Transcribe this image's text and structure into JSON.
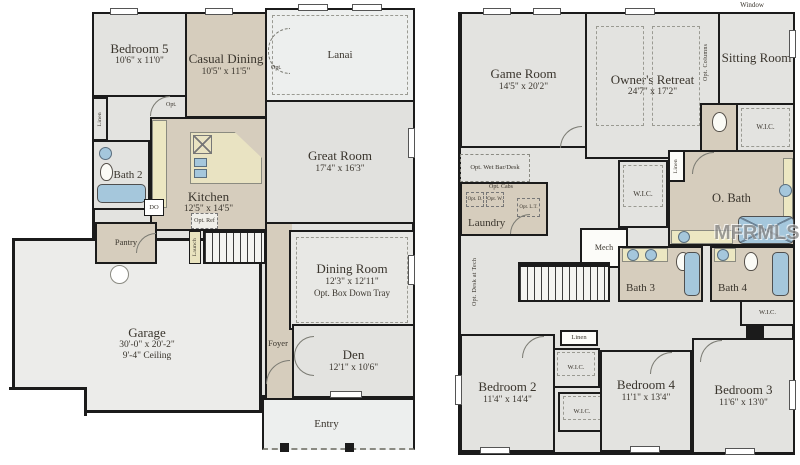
{
  "watermark": {
    "text": "MFRMLS"
  },
  "colors": {
    "wall": "#1b1b1b",
    "room_gray": "#e3e3e0",
    "tan": "#d6cdbd",
    "porch_gray": "#edefee",
    "counter_yellow": "#ece7c2",
    "fixture_blue": "#a5c7dc",
    "label_text": "#3a352d"
  },
  "floor1": {
    "rooms": {
      "bedroom5": {
        "name": "Bedroom 5",
        "dims": "10'6\" x 11'0\""
      },
      "casual_dining": {
        "name": "Casual Dining",
        "dims": "10'5\" x 11'5\""
      },
      "lanai": {
        "name": "Lanai"
      },
      "great_room": {
        "name": "Great Room",
        "dims": "17'4\" x 16'3\""
      },
      "linen": {
        "name": "Linen"
      },
      "bath2": {
        "name": "Bath 2"
      },
      "kitchen": {
        "name": "Kitchen",
        "dims": "12'5\" x 14'5\"",
        "double_oven": "DO",
        "opt_ref": "Opt. Ref",
        "launch": "Launch"
      },
      "pantry": {
        "name": "Pantry"
      },
      "dining_room": {
        "name": "Dining Room",
        "dims": "12'3\" x 12'11\"",
        "note": "Opt. Box Down Tray"
      },
      "garage": {
        "name": "Garage",
        "dims": "30'-0\" x 20'-2\"",
        "ceiling": "9'-4\" Ceiling"
      },
      "foyer": {
        "name": "Foyer"
      },
      "den": {
        "name": "Den",
        "dims": "12'1\" x 10'6\""
      },
      "entry": {
        "name": "Entry"
      }
    },
    "labels": {
      "hall_opt": "Opt.",
      "lanai_opt": "Opt."
    }
  },
  "floor2": {
    "rooms": {
      "game_room": {
        "name": "Game Room",
        "dims": "14'5\" x 20'2\""
      },
      "owners_retreat": {
        "name": "Owner's Retreat",
        "dims": "24'7\" x 17'2\""
      },
      "sitting_room": {
        "name": "Sitting Room"
      },
      "wet_bar": {
        "name": "Opt. Wet Bar/Desk"
      },
      "laundry": {
        "name": "Laundry",
        "opt_cabs": "Opt. Cabs",
        "opt_d": "Opt. D.",
        "opt_w": "Opt. W.",
        "opt_lt": "Opt. L.T."
      },
      "mech": {
        "name": "Mech"
      },
      "o_bath": {
        "name": "O. Bath"
      },
      "bath3": {
        "name": "Bath 3"
      },
      "bath4": {
        "name": "Bath 4"
      },
      "bedroom2": {
        "name": "Bedroom 2",
        "dims": "11'4\" x 14'4\""
      },
      "bedroom4": {
        "name": "Bedroom 4",
        "dims": "11'1\" x 13'4\""
      },
      "bedroom3": {
        "name": "Bedroom 3",
        "dims": "11'6\" x 13'0\""
      }
    },
    "labels": {
      "window_note": "Window",
      "opt_columns": "Opt. Columns",
      "opt_desk_tech": "Opt. Desk at Tech",
      "linen_upper": "Linen",
      "linen_lower": "Linen",
      "wic_sitting": "W.I.C.",
      "wic_owners": "W.I.C.",
      "wic_bath4": "W.I.C.",
      "wic_bed2_upper": "W.I.C.",
      "wic_bed2_lower": "W.I.C."
    }
  }
}
